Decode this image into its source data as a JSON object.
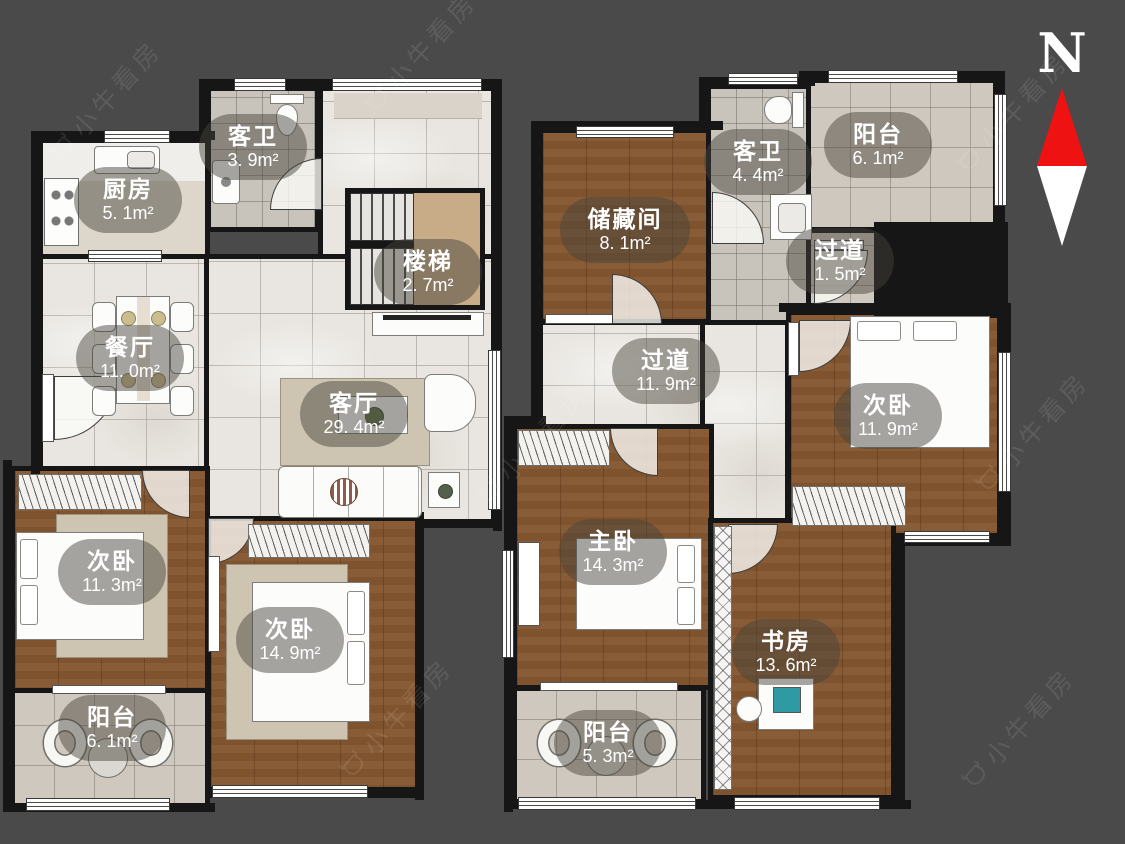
{
  "compass": {
    "label": "N"
  },
  "watermark": {
    "brand": "小牛看房"
  },
  "left": {
    "rooms": {
      "guest_bath": {
        "name": "客卫",
        "area": "3. 9m²"
      },
      "kitchen": {
        "name": "厨房",
        "area": "5. 1m²"
      },
      "stairs": {
        "name": "楼梯",
        "area": "2. 7m²"
      },
      "dining": {
        "name": "餐厅",
        "area": "11. 0m²"
      },
      "living": {
        "name": "客厅",
        "area": "29. 4m²"
      },
      "bedroom_a": {
        "name": "次卧",
        "area": "11. 3m²"
      },
      "bedroom_b": {
        "name": "次卧",
        "area": "14. 9m²"
      },
      "balcony": {
        "name": "阳台",
        "area": "6. 1m²"
      }
    }
  },
  "right": {
    "rooms": {
      "storage": {
        "name": "储藏间",
        "area": "8. 1m²"
      },
      "guest_bath": {
        "name": "客卫",
        "area": "4. 4m²"
      },
      "balcony_top": {
        "name": "阳台",
        "area": "6. 1m²"
      },
      "hallway_small": {
        "name": "过道",
        "area": "1. 5m²"
      },
      "hallway": {
        "name": "过道",
        "area": "11. 9m²"
      },
      "bedroom": {
        "name": "次卧",
        "area": "11. 9m²"
      },
      "master_bedroom": {
        "name": "主卧",
        "area": "14. 3m²"
      },
      "study": {
        "name": "书房",
        "area": "13. 6m²"
      },
      "balcony_bottom": {
        "name": "阳台",
        "area": "5. 3m²"
      }
    }
  }
}
